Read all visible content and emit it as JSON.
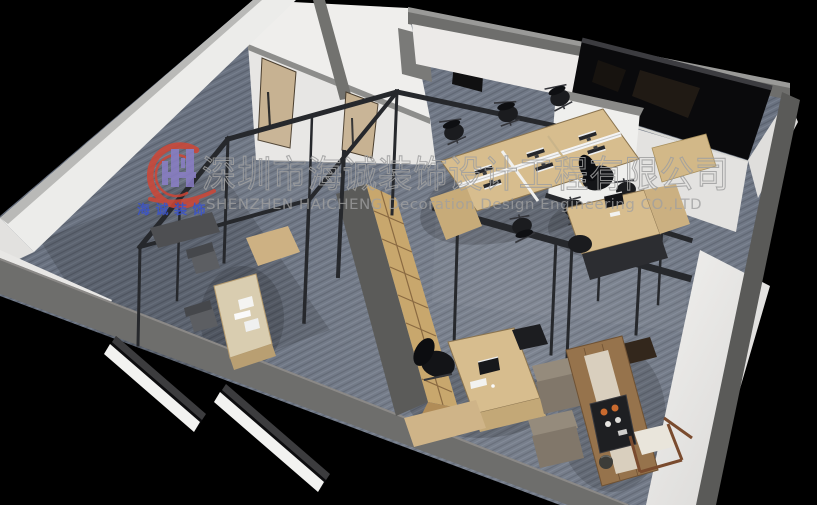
{
  "watermark": {
    "company_name_zh": "深圳市海诚装饰设计工程有限公司",
    "company_name_en": "SHENZHEN HAICHENG Decoration Design Engineering CO.,LTD",
    "logo_text_zh": "海诚装饰"
  },
  "colors": {
    "background": "#000000",
    "carpet": "#6a7280",
    "carpet_shadow": "#4f5560",
    "wall_white": "#ececea",
    "wall_shadow": "#dddcda",
    "wall_top_gray": "#6e6e6c",
    "wall_top_dark": "#5a5a58",
    "partition_black": "#26282c",
    "wood_light": "#d7bd8e",
    "wood_medium": "#c7ab79",
    "wood_cabinet": "#c8a76d",
    "wood_dark": "#96734c",
    "door_wood": "#c7b292",
    "glass_dark": "#0a0a0c",
    "chair_black": "#17181b",
    "lounge_taupe": "#8d8274",
    "cushion_white": "#e9e5db",
    "tray_black": "#1e1f22",
    "cup_orange": "#c96a2e",
    "watermark_gray": "#a0a0a0",
    "logo_red": "#cf4636",
    "logo_purple": "#8a7ec6",
    "logo_blue": "#3a53cc"
  }
}
